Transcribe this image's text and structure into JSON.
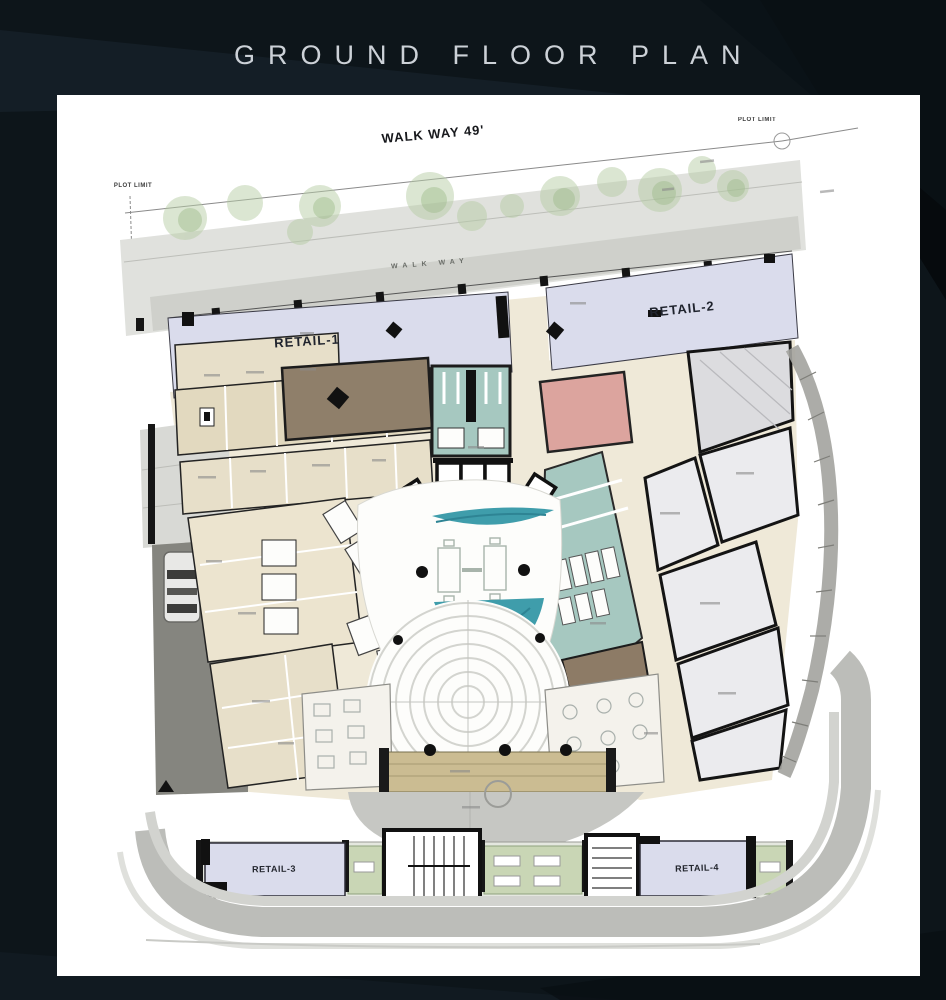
{
  "page": {
    "title": "GROUND FLOOR PLAN"
  },
  "plan": {
    "walkway_label": "WALK WAY 49'",
    "plot_limit_left": "PLOT LIMIT",
    "plot_limit_right": "PLOT LIMIT",
    "walkway_band_label": "WALK WAY",
    "retail1": "RETAIL-1",
    "retail2": "RETAIL-2",
    "retail3": "RETAIL-3",
    "retail4": "RETAIL-4",
    "colors": {
      "background": "#0d151a",
      "title_text": "#ccd1d7",
      "card": "#ffffff",
      "retail_fill": "#dadcec",
      "room_beige": "#e7dfc9",
      "corridor_cream": "#efe9d8",
      "toilet_teal": "#a6c8c0",
      "pool_teal": "#3f9dab",
      "room_pink": "#dca49e",
      "room_brown": "#8d7b66",
      "plant_room_gray": "#ebebee",
      "tree_green": "#b5cba4",
      "pavement_gray": "#c6c7c3",
      "wall_black": "#1a1a1a"
    }
  }
}
